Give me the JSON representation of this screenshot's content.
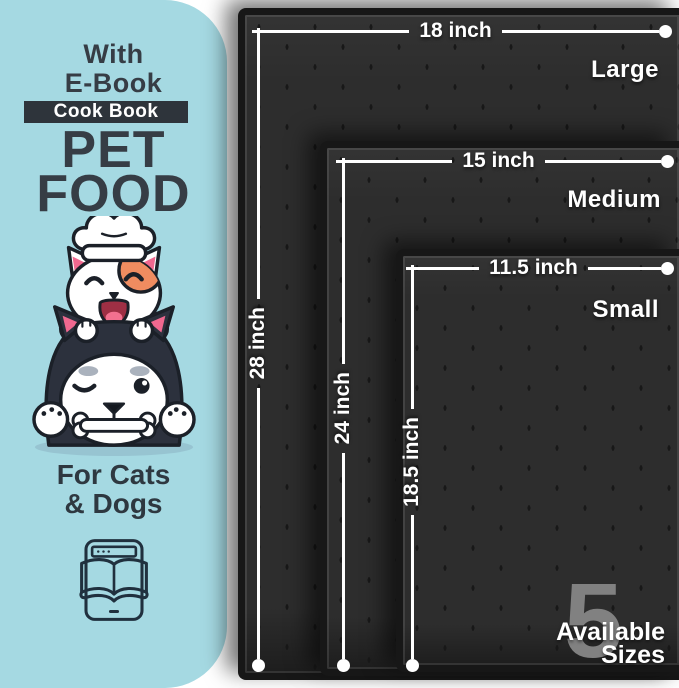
{
  "panel": {
    "bg_color": "#a5d9e2",
    "with_line1": "With",
    "with_line2": "E-Book",
    "badge_label": "Cook Book",
    "title_line1": "PET",
    "title_line2": "FOOD",
    "audience_line1": "For Cats",
    "audience_line2": "& Dogs",
    "mascot_icon": "cat-and-dog-chef-mascot",
    "ebook_icon": "ebook-tablet-icon"
  },
  "mats": {
    "surface_color": "#2d2d2d",
    "line_color": "#ffffff",
    "items": [
      {
        "name": "Large",
        "width_label": "18 inch",
        "height_label": "28 inch"
      },
      {
        "name": "Medium",
        "width_label": "15 inch",
        "height_label": "24 inch"
      },
      {
        "name": "Small",
        "width_label": "11.5 inch",
        "height_label": "18.5 inch"
      }
    ]
  },
  "footer": {
    "count": "5",
    "line1": "Available",
    "line2": "Sizes"
  }
}
